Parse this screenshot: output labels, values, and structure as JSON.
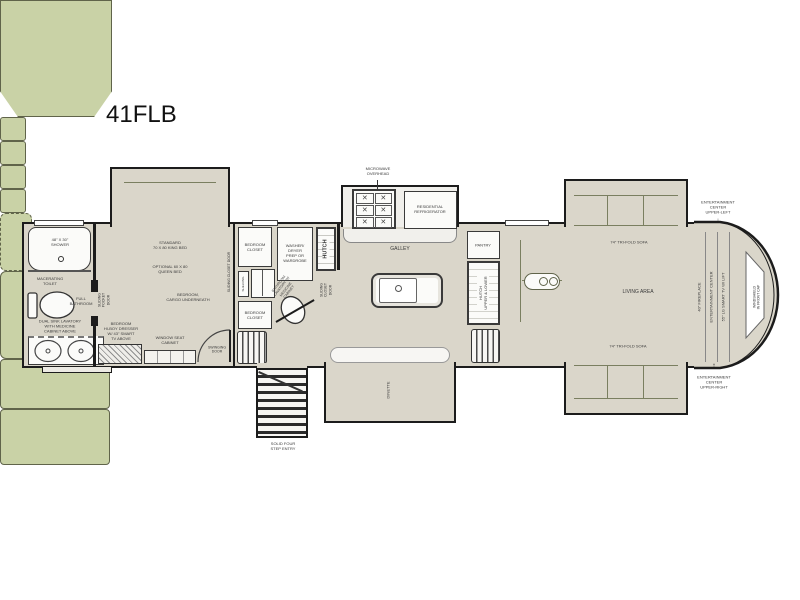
{
  "title": "41FLB",
  "colors": {
    "floor": "#dad6ca",
    "furniture_green": "#c9d2a6",
    "wall": "#1c1c1c",
    "fixture_white": "#fbfbf9"
  },
  "bathroom": {
    "shower": "48\" X 30\"\nSHOWER",
    "toilet": "MACERATING\nTOILET",
    "full_bathroom": "FULL\nBATHROOM",
    "lavatory": "DUAL SINK LAVATORY\nWITH MEDICINE\nCABINET ABOVE",
    "pocket_door": "SLIDING\nPOCKET\nDOOR"
  },
  "bedroom": {
    "bed_standard": "STANDARD\n70 X 80 KING BED",
    "bed_optional": "OPTIONAL 60 X 80\nQUEEN BED",
    "cargo": "BEDROOM,\nCARGO UNDERNEATH",
    "dresser": "BEDROOM\nHI-BOY DRESSER\nW/ 43\" SMART\nTV ABOVE",
    "window_seat": "WINDOW SEAT\nCABINET",
    "swinging_door": "SWINGING\nDOOR",
    "sliding_closet_door": "SLIDING CLOSET DOOR",
    "closet_top": "BEDROOM\nCLOSET",
    "closet_bottom": "BEDROOM\nCLOSET",
    "shelving": "SHELVING",
    "washer_dryer": "WASHER/\nDRYER\nPREP OR\nWARDROBE",
    "bath_lavatory": "BATHROOM\nLAVATORY W/\nMEDICINE\nCABINET",
    "hutch": "HUTCH",
    "sliding_closet_door_2": "SLIDING\nCLOSET\nDOOR"
  },
  "galley": {
    "microwave": "MICROWAVE\nOVERHEAD",
    "refrigerator": "RESIDENTIAL\nREFRIGERATOR",
    "galley": "GALLEY",
    "pantry": "PANTRY",
    "hutch_upper_lower": "HUTCH\nUPPER & LOWER"
  },
  "entry": {
    "steps": "SOLID FOUR\nSTEP ENTRY"
  },
  "living": {
    "living_area": "LIVING AREA",
    "sofa_top": "74\" TRI-FOLD SOFA",
    "sofa_bottom": "74\" TRI-FOLD SOFA",
    "dinette": "DINETTE",
    "ec_upper_left": "ENTERTAINMENT\nCENTER\nUPPER-LEFT",
    "ec_upper_right": "ENTERTAINMENT\nCENTER\nUPPER-RIGHT",
    "arrow_down": "↓",
    "arrow_up": "↑",
    "fireplace": "40\" FIREPLACE",
    "entertainment_center": "ENTERTAINMENT CENTER",
    "tv": "55\" LG SMART TV W/ LIFT",
    "windshield": "WINDSHIELD\nIN FRONT CAP"
  }
}
